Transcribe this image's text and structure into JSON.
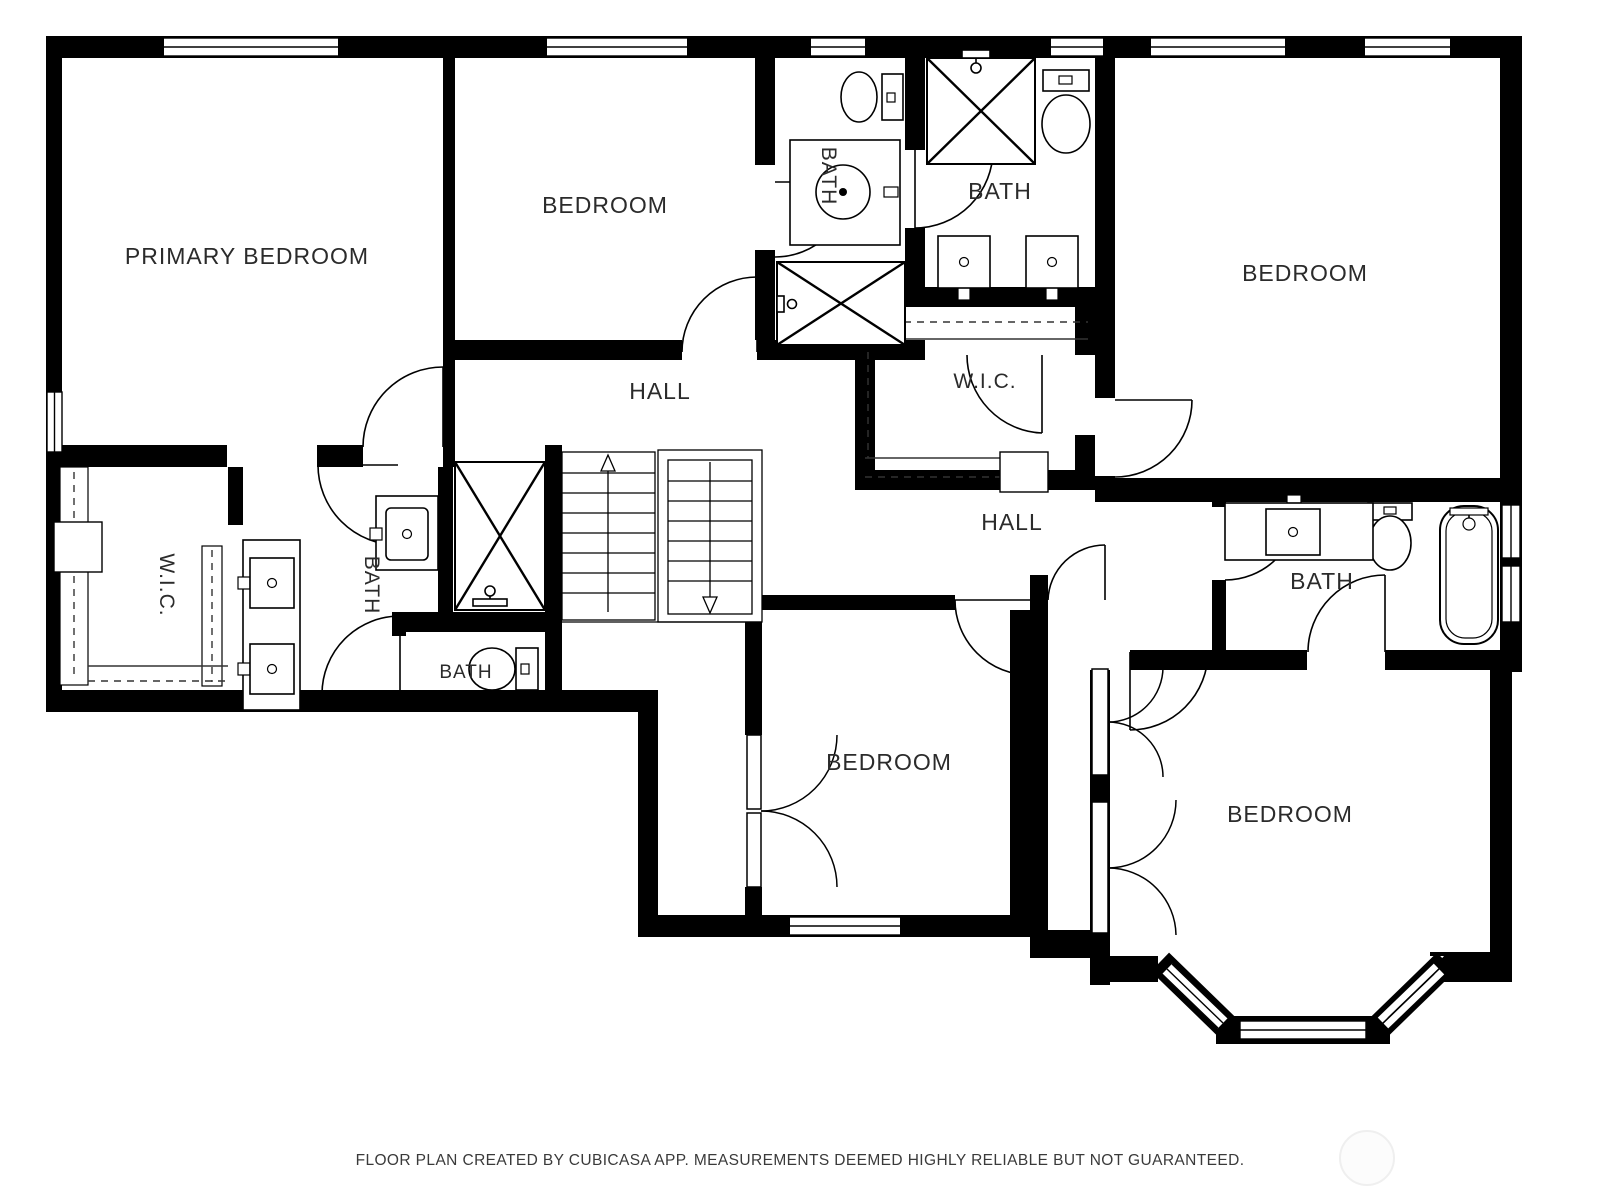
{
  "floor_plan": {
    "labels": {
      "primary_bedroom": "PRIMARY BEDROOM",
      "bedroom_top_middle": "BEDROOM",
      "bath_top_middle": "BATH",
      "bath_top_right": "BATH",
      "bedroom_top_right": "BEDROOM",
      "hall_upper": "HALL",
      "wic_right": "W.I.C.",
      "hall_right": "HALL",
      "bath_right": "BATH",
      "wic_left": "W.I.C.",
      "bath_middle_left": "BATH",
      "bath_small": "BATH",
      "bedroom_bottom_middle": "BEDROOM",
      "bedroom_bottom_right": "BEDROOM"
    },
    "footer": "FLOOR PLAN CREATED BY CUBICASA APP. MEASUREMENTS DEEMED HIGHLY RELIABLE BUT NOT GUARANTEED.",
    "colors": {
      "wall": "#000000",
      "background": "#ffffff",
      "label": "#2b2b2b"
    },
    "fixtures": [
      "toilet",
      "round-sink-vanity",
      "double-sink-vanity",
      "square-sink",
      "bathtub",
      "shower",
      "closet-rod",
      "stairs-up",
      "stairs-down",
      "bay-window"
    ]
  }
}
